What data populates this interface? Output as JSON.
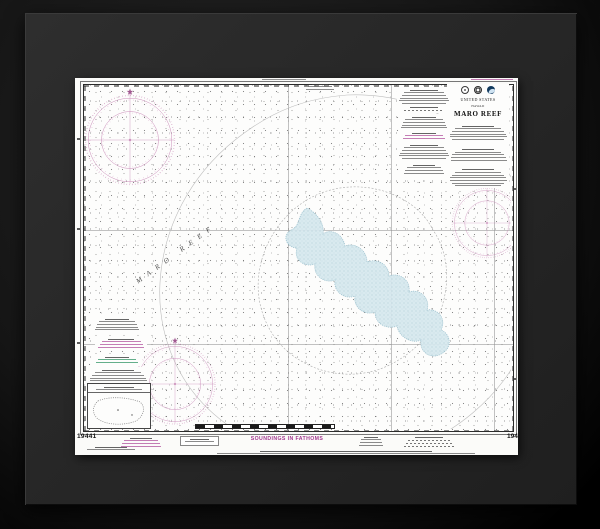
{
  "product": {
    "description": "framed-nautical-chart",
    "backdrop_color": "#161616",
    "frame_color": "#272727",
    "paper_color": "#fbfbf9"
  },
  "chart": {
    "title_block": {
      "country": "UNITED STATES",
      "region": "HAWAII",
      "title": "MARO REEF",
      "logos": [
        "department-of-commerce-seal",
        "national-ocean-service-emblem",
        "noaa-logo"
      ]
    },
    "feature_label": "MARO REEF",
    "soundings_note": "SOUNDINGS IN FATHOMS",
    "number_bottom_left": "19441",
    "number_bottom_right": "19441",
    "colors": {
      "magenta_accent": "#b55ca2",
      "compass_rose": "#bd6fa8",
      "reef_shading": "#d8e9ef",
      "green_note": "#3d9b6e",
      "graticule": "#8f8f8f"
    }
  }
}
